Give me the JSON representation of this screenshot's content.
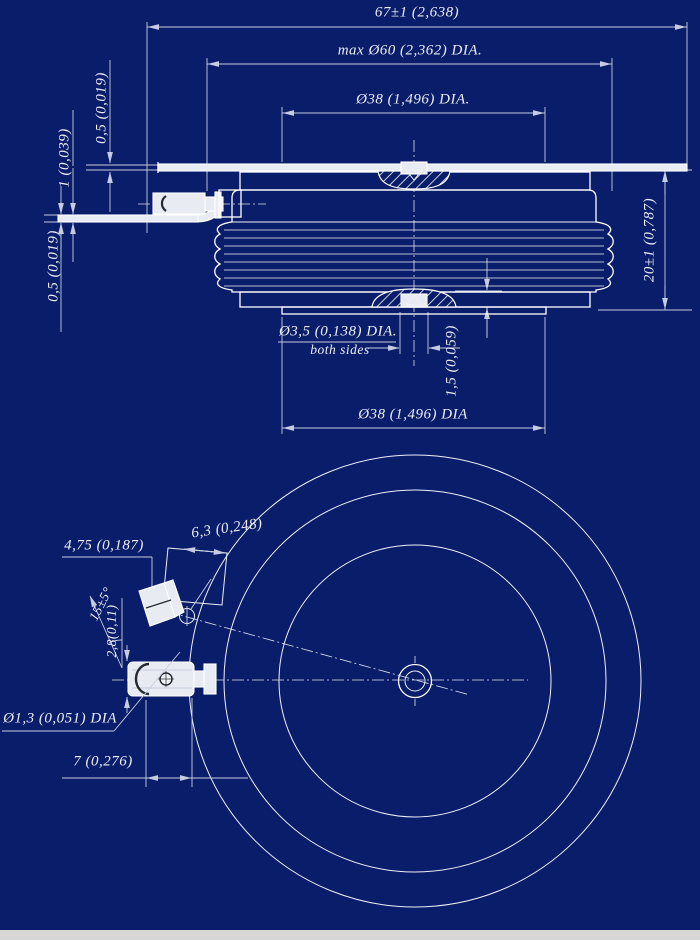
{
  "drawing": {
    "type": "technical-blueprint",
    "subject": "disc (puck) semiconductor device outline drawing, side section view and bottom view",
    "colors": {
      "background": "#0a1d6a",
      "line": "#ffffff",
      "dimension": "#c6ccdf",
      "footer_strip": "#d6d6d6"
    },
    "side_view": {
      "dim_overall_width": "67±1 (2,638)",
      "dim_max_diameter": "max Ø60 (2,362) DIA.",
      "dim_top_pole_diameter": "Ø38 (1,496) DIA.",
      "dim_top_lead_thickness": "0,5 (0,019)",
      "dim_gate_lead_thickness": "1 (0,039)",
      "dim_bottom_lead_thickness": "0,5 (0,019)",
      "dim_height": "20±1 (0,787)",
      "dim_center_recess_diameter": "Ø3,5 (0,138) DIA.",
      "center_recess_note": "both sides",
      "dim_recess_depth": "1,5 (0,059)",
      "dim_bottom_pole_diameter": "Ø38 (1,496) DIA"
    },
    "bottom_view": {
      "dim_terminal_width": "4,75 (0,187)",
      "dim_tab_width": "6,3 (0,248)",
      "dim_lead_angle": "15±5°",
      "dim_tube_diameter": "2,8(0,11)",
      "dim_hole_diameter": "Ø1,3 (0,051) DIA",
      "dim_lead_length": "7 (0,276)"
    }
  }
}
